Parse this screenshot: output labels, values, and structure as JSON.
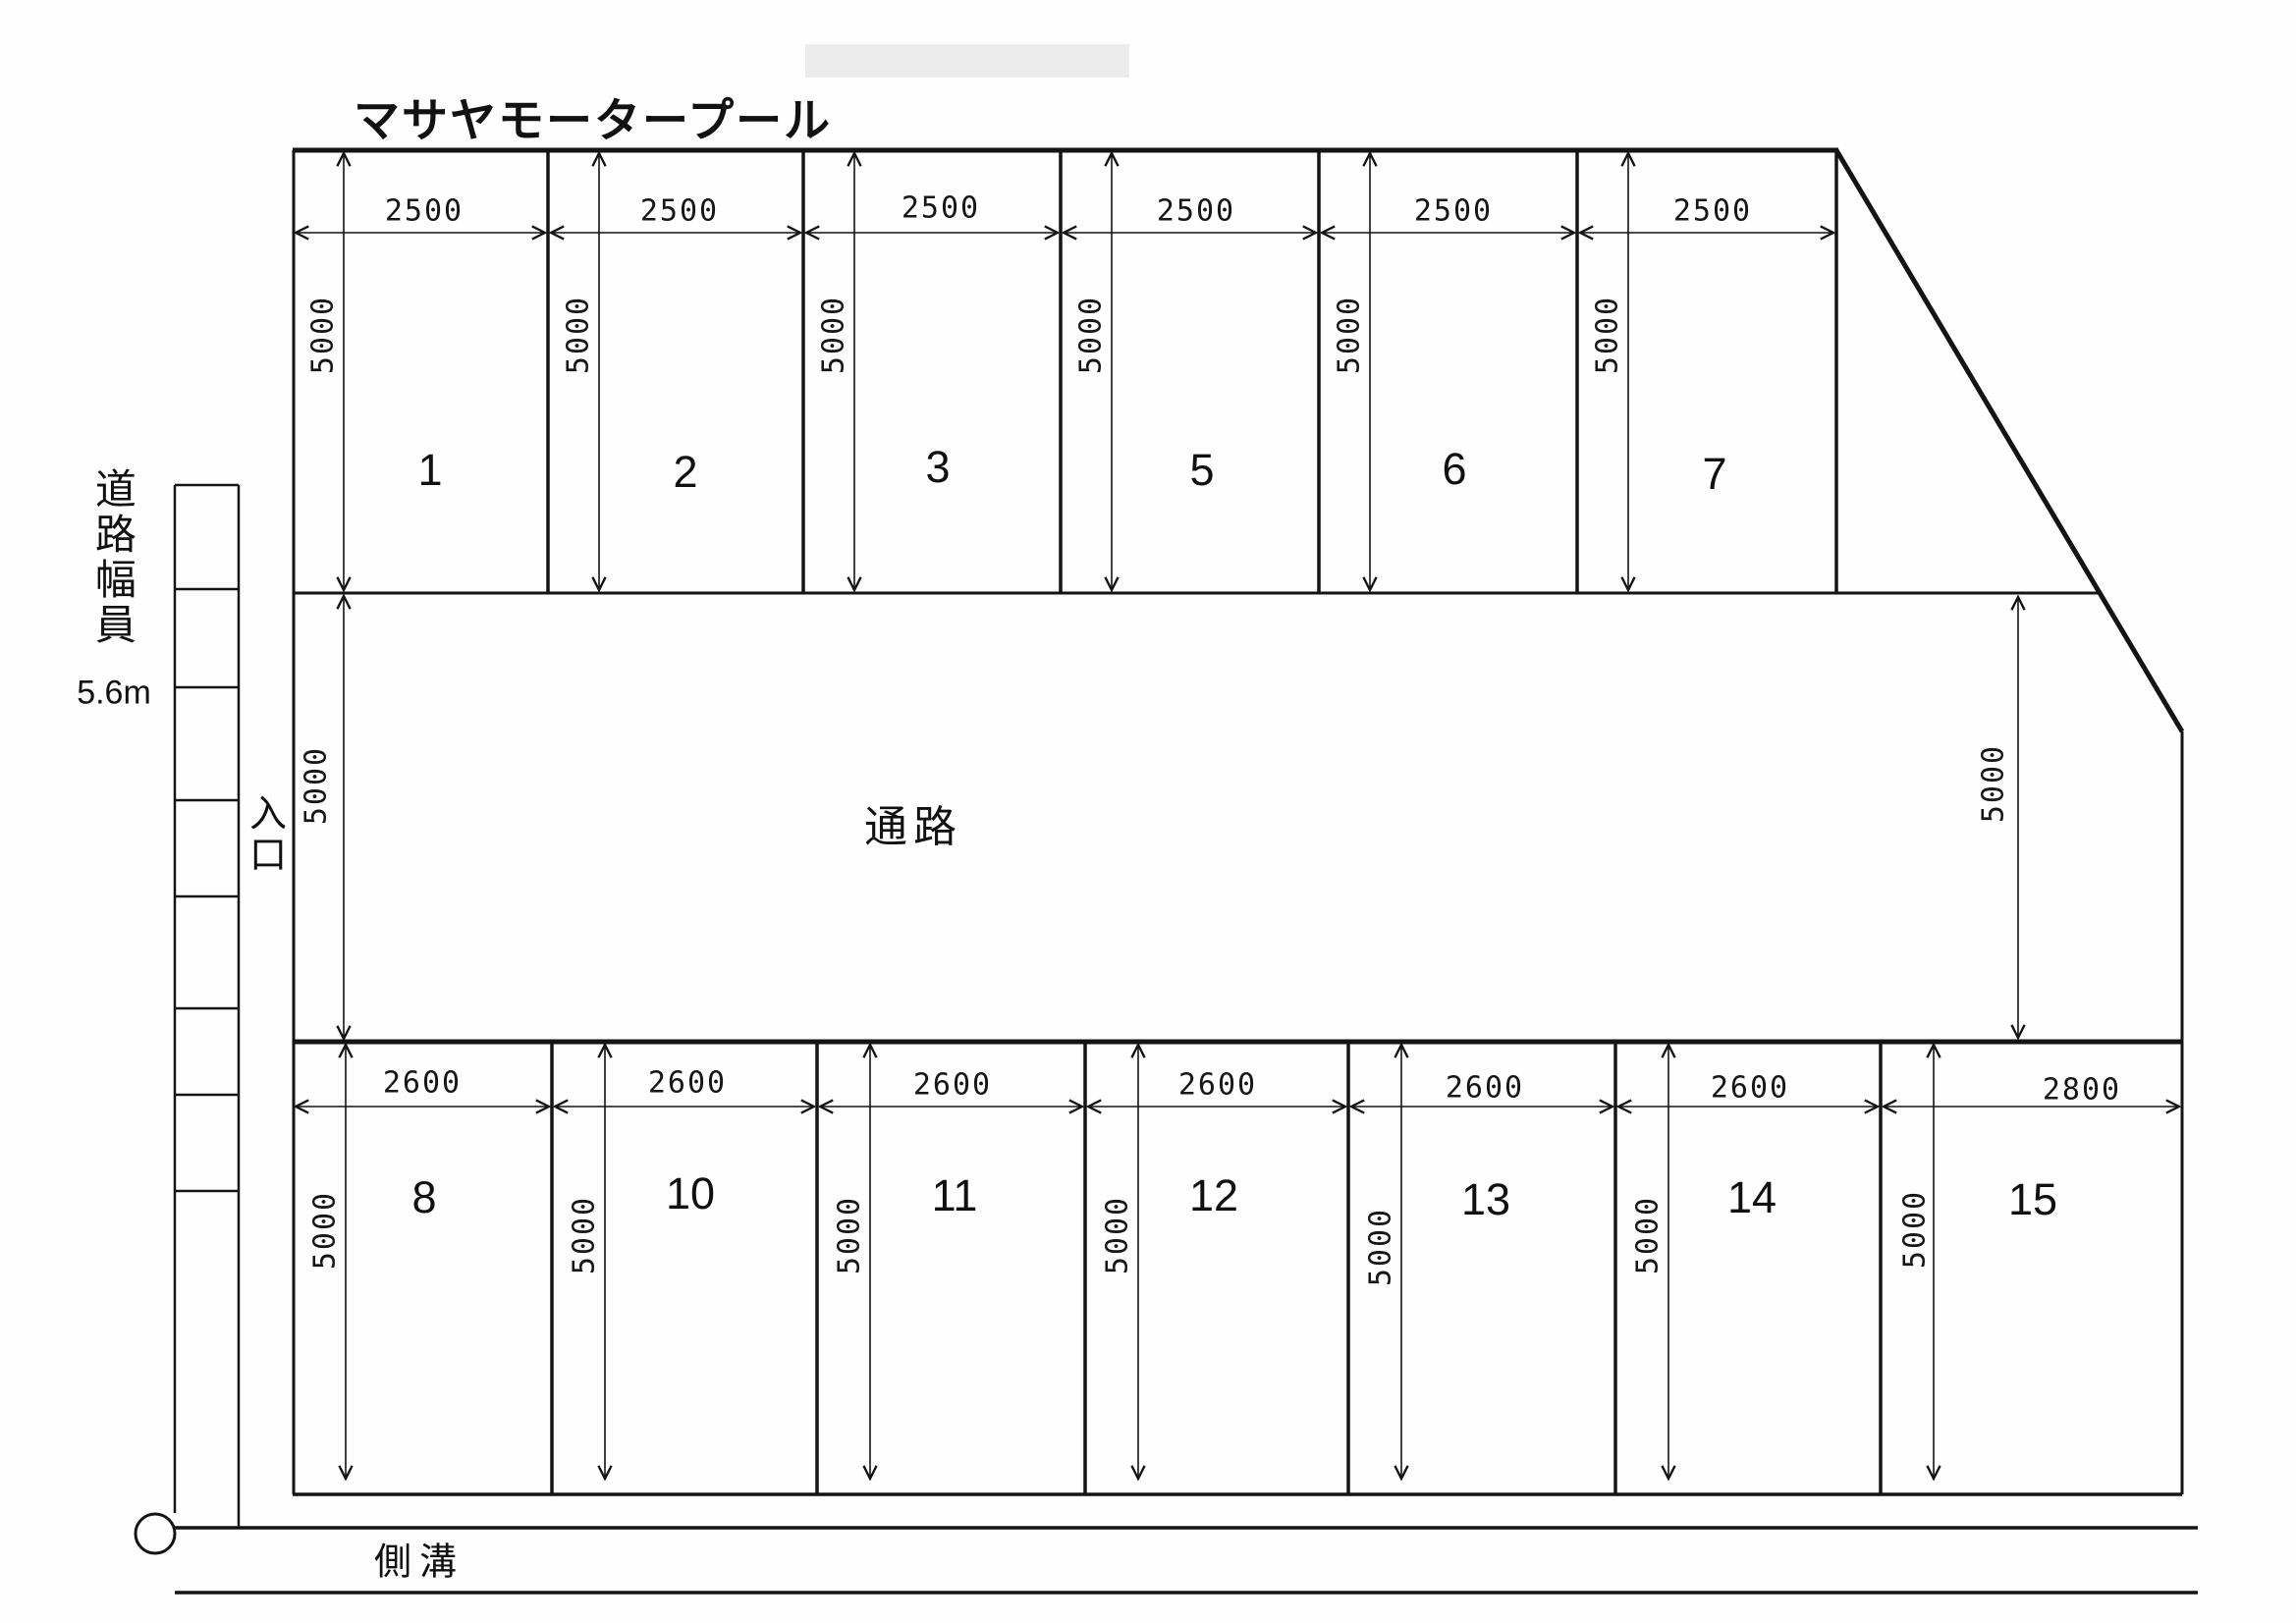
{
  "title": "マサヤモータープール",
  "colors": {
    "line": "#141414",
    "background": "#fefefe",
    "smudge": "#ececec"
  },
  "road": {
    "label": "道路幅員",
    "width_value": "5.6m"
  },
  "entrance": {
    "label": "入口"
  },
  "gutter": {
    "label": "側溝"
  },
  "aisle": {
    "label": "通路",
    "left_depth": "5000",
    "right_depth": "5000"
  },
  "top_row": {
    "cells": [
      {
        "number": "1",
        "width": "2500",
        "depth": "5000"
      },
      {
        "number": "2",
        "width": "2500",
        "depth": "5000"
      },
      {
        "number": "3",
        "width": "2500",
        "depth": "5000"
      },
      {
        "number": "5",
        "width": "2500",
        "depth": "5000"
      },
      {
        "number": "6",
        "width": "2500",
        "depth": "5000"
      },
      {
        "number": "7",
        "width": "2500",
        "depth": "5000"
      }
    ]
  },
  "bottom_row": {
    "cells": [
      {
        "number": "8",
        "width": "2600",
        "depth": "5000"
      },
      {
        "number": "10",
        "width": "2600",
        "depth": "5000"
      },
      {
        "number": "11",
        "width": "2600",
        "depth": "5000"
      },
      {
        "number": "12",
        "width": "2600",
        "depth": "5000"
      },
      {
        "number": "13",
        "width": "2600",
        "depth": "5000"
      },
      {
        "number": "14",
        "width": "2600",
        "depth": "5000"
      },
      {
        "number": "15",
        "width": "2800",
        "depth": "5000"
      }
    ]
  }
}
